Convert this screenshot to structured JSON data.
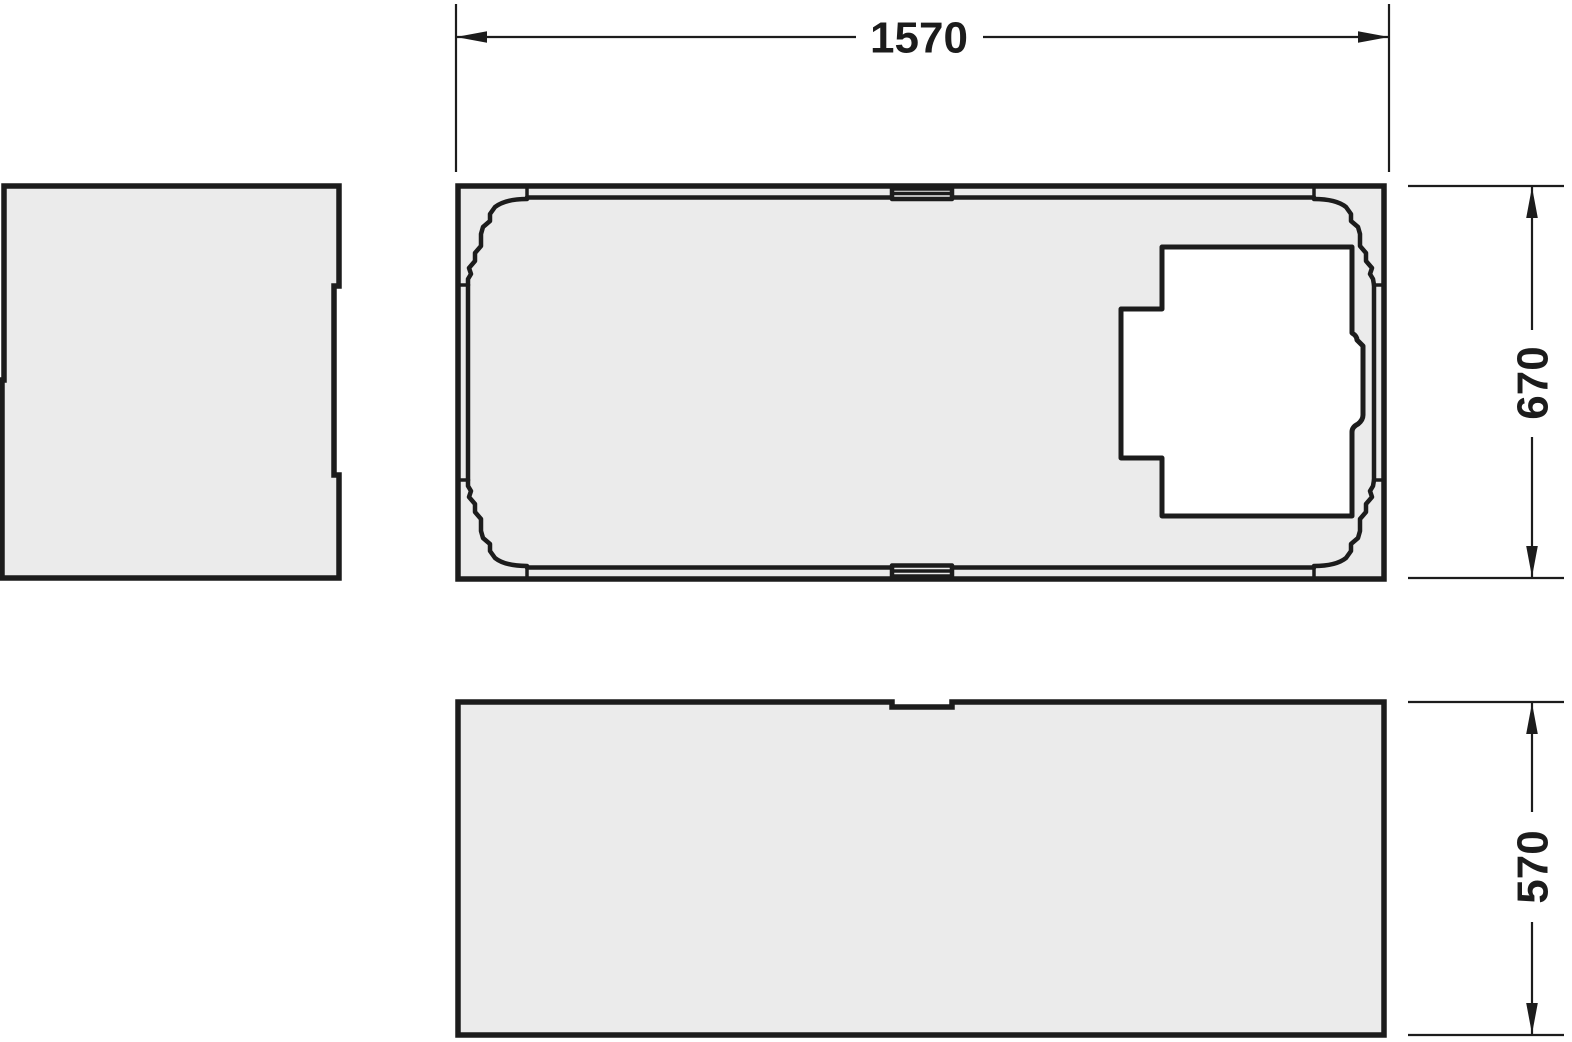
{
  "drawing": {
    "dimensions": {
      "overall_width": "1570",
      "overall_depth": "670",
      "panel_height": "570"
    },
    "colors": {
      "line": "#1c1c1c",
      "panel_fill": "#ebebeb",
      "cutout_fill": "#ffffff",
      "background": "#ffffff"
    }
  }
}
